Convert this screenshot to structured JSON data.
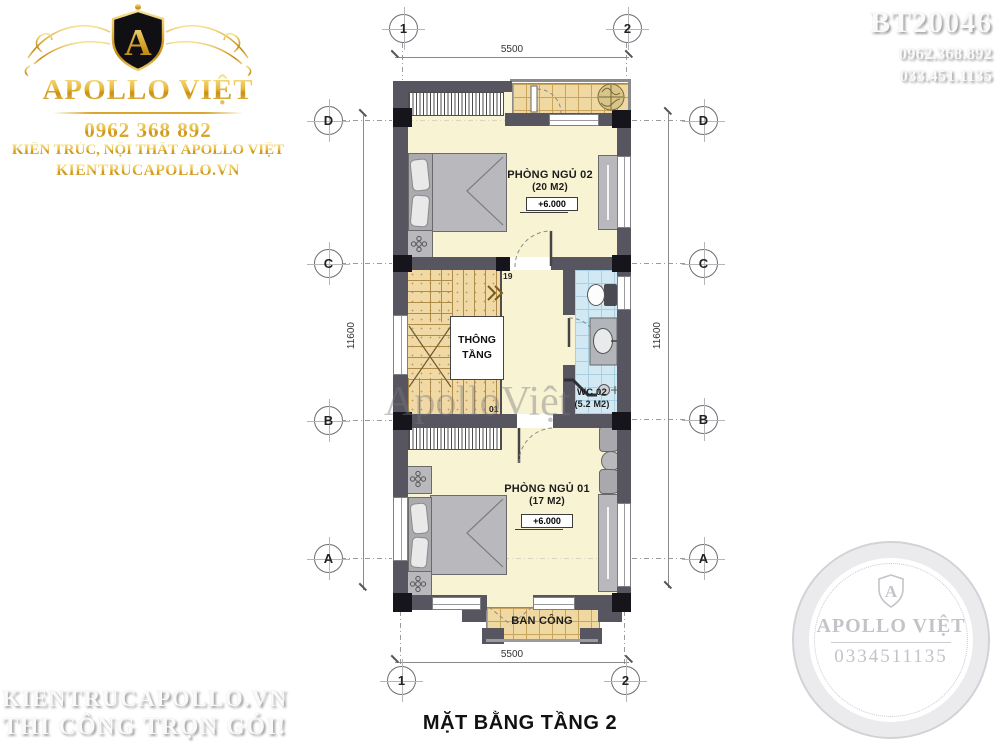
{
  "logo": {
    "monogram": "A",
    "name": "APOLLO VIỆT",
    "phone": "0962 368 892",
    "tagline": "KIẾN TRÚC, NỘI THẤT APOLLO VIỆT",
    "website": "KIENTRUCAPOLLO.VN"
  },
  "ref": {
    "code": "BT20046",
    "phone1": "0962.368.892",
    "phone2": "033.451.1135"
  },
  "footer_watermark": {
    "line1": "KIENTRUCAPOLLO.VN",
    "line2": "THI CÔNG TRỌN GÓI!"
  },
  "seal": {
    "monogram": "A",
    "name": "APOLLO VIỆT",
    "phone": "0334511135"
  },
  "plan": {
    "title": "MẶT BẰNG TẦNG 2",
    "watermark": "ApolloViệt",
    "axes": {
      "col1": "1",
      "col2": "2",
      "rowD": "D",
      "rowC": "C",
      "rowB": "B",
      "rowA": "A"
    },
    "dims": {
      "width": "5500",
      "height": "11600"
    },
    "rooms": {
      "bedroom2": {
        "name": "PHÒNG NGỦ 02",
        "area": "(20 M2)",
        "level": "+6.000"
      },
      "void": {
        "name": "THÔNG TẦNG"
      },
      "wc": {
        "name": "WC 02",
        "area": "(5.2 M2)"
      },
      "bedroom1": {
        "name": "PHÒNG NGỦ 01",
        "area": "(17 M2)",
        "level": "+6.000"
      },
      "balcony": {
        "name": "BAN CÔNG"
      }
    },
    "stairs": {
      "top_step": "19",
      "bottom_step": "01"
    }
  },
  "colors": {
    "wall": "#57555F",
    "column": "#17151C",
    "floor": "#F8F3D3",
    "stair_tile": "#F0D9A4",
    "wc_tile": "#D2E9F4",
    "furniture": "#B9B9BD",
    "gold": "#D9A62E"
  }
}
